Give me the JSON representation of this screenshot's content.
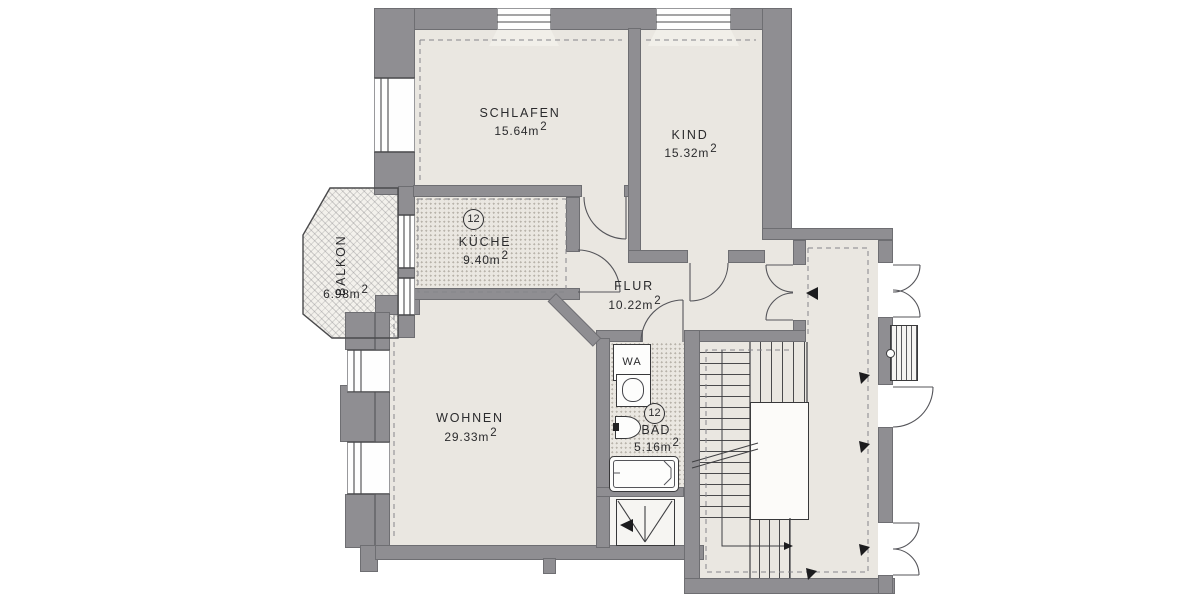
{
  "rooms": {
    "schlafen": {
      "name": "SCHLAFEN",
      "area_value": "15.64",
      "area_unit": "m",
      "area_sup": "2"
    },
    "kind": {
      "name": "KIND",
      "area_value": "15.32",
      "area_unit": "m",
      "area_sup": "2"
    },
    "kueche": {
      "name": "KÜCHE",
      "area_value": "9.40",
      "area_unit": "m",
      "area_sup": "2",
      "badge": "12"
    },
    "balkon": {
      "name": "BALKON",
      "area_value": "6.98",
      "area_unit": "m",
      "area_sup": "2"
    },
    "flur": {
      "name": "FLUR",
      "area_value": "10.22",
      "area_unit": "m",
      "area_sup": "2"
    },
    "wohnen": {
      "name": "WOHNEN",
      "area_value": "29.33",
      "area_unit": "m",
      "area_sup": "2"
    },
    "bad": {
      "name": "BAD",
      "area_value": "5.16",
      "area_unit": "m",
      "area_sup": "2",
      "badge": "12"
    }
  },
  "fixtures": {
    "washer_label": "WA"
  },
  "colors": {
    "wall": "#8f8e92",
    "floor": "#eae7e1",
    "line": "#4a4a4c",
    "text": "#2b2b2d",
    "background": "#ffffff"
  }
}
